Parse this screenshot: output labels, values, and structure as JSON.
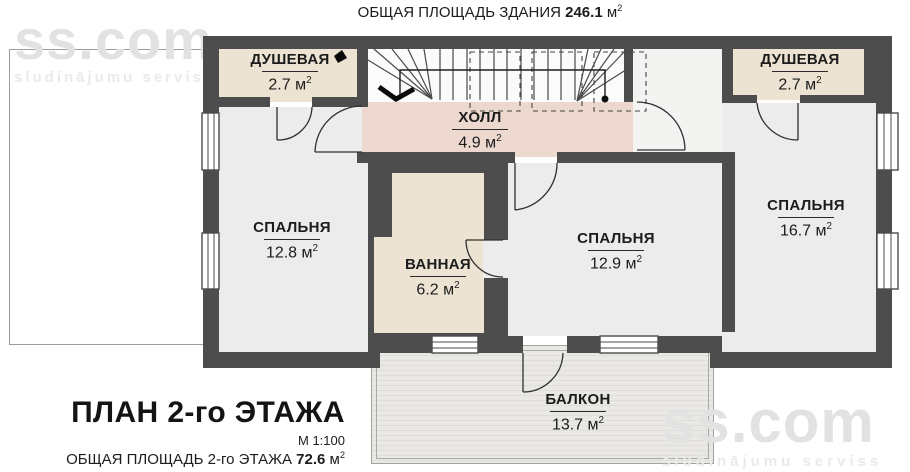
{
  "header": {
    "label": "ОБЩАЯ ПЛОЩАДЬ ЗДАНИЯ",
    "value": "246.1"
  },
  "units": {
    "m": "м",
    "sup": "2"
  },
  "watermark": {
    "logo": "ss.com",
    "tagline": "sludinājumu serviss"
  },
  "rooms": [
    {
      "id": "shower-left",
      "name": "ДУШЕВАЯ",
      "area": "2.7"
    },
    {
      "id": "hall",
      "name": "ХОЛЛ",
      "area": "4.9"
    },
    {
      "id": "bedroom-left",
      "name": "СПАЛЬНЯ",
      "area": "12.8"
    },
    {
      "id": "bathroom",
      "name": "ВАННАЯ",
      "area": "6.2"
    },
    {
      "id": "bedroom-middle",
      "name": "СПАЛЬНЯ",
      "area": "12.9"
    },
    {
      "id": "shower-right",
      "name": "ДУШЕВАЯ",
      "area": "2.7"
    },
    {
      "id": "bedroom-right",
      "name": "СПАЛЬНЯ",
      "area": "16.7"
    },
    {
      "id": "balcony",
      "name": "БАЛКОН",
      "area": "13.7"
    }
  ],
  "footer": {
    "title": "ПЛАН 2-го ЭТАЖА",
    "scale": "М 1:100",
    "area_label": "ОБЩАЯ ПЛОЩАДЬ 2-го ЭТАЖА",
    "area_value": "72.6"
  },
  "colors": {
    "wall": "#4d4d4d",
    "warm_room": "#ece3d3",
    "hall": "#ecd8ce",
    "room": "#ececec",
    "stairs": "#fbfbfb",
    "landing": "#f3f3f2",
    "balcony": "#e9e8e4"
  }
}
